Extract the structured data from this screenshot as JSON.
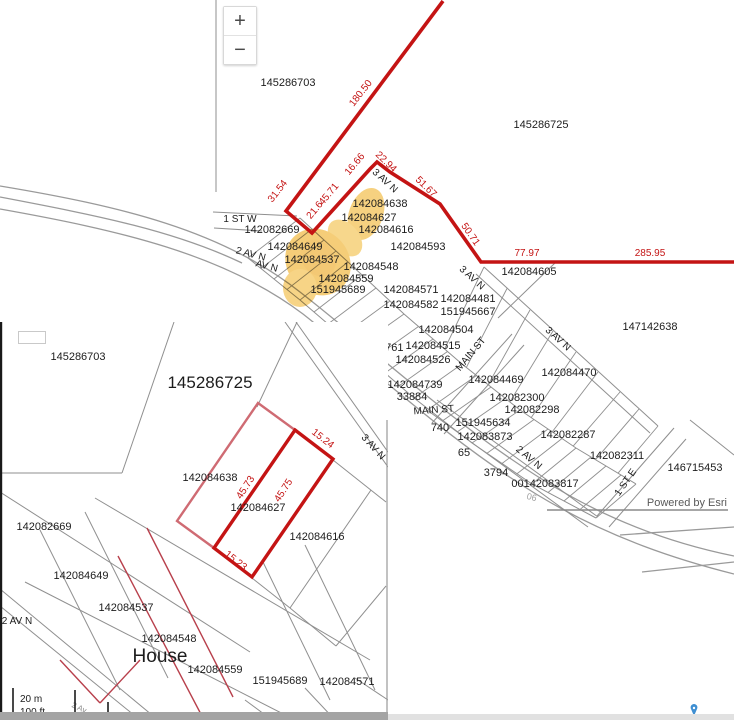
{
  "attribution": {
    "text": "Powered by Esri"
  },
  "zoom_controls": {
    "zoom_in": "+",
    "zoom_out": "−"
  },
  "colors": {
    "boundary_red": "#c41414",
    "thin_red": "#b8404c",
    "pink_red": "#cf6b73",
    "highlight_yellow": "#efab1e",
    "parcel_line_gray": "#8f8f8f",
    "label_black": "#1c1c1c",
    "attribution_gray": "#595959",
    "pin_blue": "#3f8fd2"
  },
  "main_map": {
    "parcel_labels": [
      {
        "t": "145286703",
        "x": 288,
        "y": 86
      },
      {
        "t": "145286725",
        "x": 541,
        "y": 128
      },
      {
        "t": "142084638",
        "x": 380,
        "y": 207
      },
      {
        "t": "142084627",
        "x": 369,
        "y": 221
      },
      {
        "t": "142084616",
        "x": 386,
        "y": 233
      },
      {
        "t": "142082669",
        "x": 272,
        "y": 233
      },
      {
        "t": "142084593",
        "x": 418,
        "y": 250
      },
      {
        "t": "142084649",
        "x": 295,
        "y": 250
      },
      {
        "t": "142084537",
        "x": 312,
        "y": 263
      },
      {
        "t": "142084605",
        "x": 529,
        "y": 275
      },
      {
        "t": "142084548",
        "x": 371,
        "y": 270
      },
      {
        "t": "142084559",
        "x": 346,
        "y": 282
      },
      {
        "t": "151945689",
        "x": 338,
        "y": 293
      },
      {
        "t": "142084571",
        "x": 411,
        "y": 293
      },
      {
        "t": "142084582",
        "x": 411,
        "y": 308
      },
      {
        "t": "142084481",
        "x": 468,
        "y": 302
      },
      {
        "t": "151945667",
        "x": 468,
        "y": 315
      },
      {
        "t": "147142638",
        "x": 650,
        "y": 330
      },
      {
        "t": "142084504",
        "x": 446,
        "y": 333
      },
      {
        "t": "126398",
        "x": 351,
        "y": 339
      },
      {
        "t": "142083761",
        "x": 376,
        "y": 351
      },
      {
        "t": "142084515",
        "x": 433,
        "y": 349
      },
      {
        "t": "142084526",
        "x": 423,
        "y": 363
      },
      {
        "t": "142084470",
        "x": 569,
        "y": 376
      },
      {
        "t": "142084469",
        "x": 496,
        "y": 383
      },
      {
        "t": "142084739",
        "x": 415,
        "y": 388
      },
      {
        "t": "33884",
        "x": 412,
        "y": 400
      },
      {
        "t": "142082300",
        "x": 517,
        "y": 401
      },
      {
        "t": "142082298",
        "x": 532,
        "y": 413
      },
      {
        "t": "151945634",
        "x": 483,
        "y": 426
      },
      {
        "t": "740",
        "x": 440,
        "y": 431
      },
      {
        "t": "142083873",
        "x": 485,
        "y": 440
      },
      {
        "t": "142082287",
        "x": 568,
        "y": 438
      },
      {
        "t": "65",
        "x": 464,
        "y": 456
      },
      {
        "t": "142082311",
        "x": 617,
        "y": 459
      },
      {
        "t": "146715453",
        "x": 695,
        "y": 471
      },
      {
        "t": "3794",
        "x": 496,
        "y": 476
      },
      {
        "t": "00142083817",
        "x": 545,
        "y": 487
      },
      {
        "t": "06",
        "x": 531,
        "y": 500,
        "r": 15,
        "s": 9,
        "c": "#a0a0a0"
      }
    ],
    "street_labels": [
      {
        "t": "1 ST W",
        "x": 240,
        "y": 222
      },
      {
        "t": "2 AV N",
        "x": 250,
        "y": 257,
        "r": 15
      },
      {
        "t": "AV N",
        "x": 266,
        "y": 269,
        "r": 15
      },
      {
        "t": "3 AV N",
        "x": 383,
        "y": 183,
        "r": 42
      },
      {
        "t": "3 AV N",
        "x": 470,
        "y": 280,
        "r": 42
      },
      {
        "t": "3 AV N",
        "x": 556,
        "y": 341,
        "r": 42
      },
      {
        "t": "MAIN ST",
        "x": 473,
        "y": 356,
        "r": -50
      },
      {
        "t": "MAIN ST",
        "x": 434,
        "y": 413,
        "r": -4
      },
      {
        "t": "2 AV N",
        "x": 527,
        "y": 460,
        "r": 40
      },
      {
        "t": "1 ST E",
        "x": 628,
        "y": 484,
        "r": -55
      }
    ],
    "measurements": [
      {
        "t": "180.50",
        "x": 363,
        "y": 95,
        "r": -52
      },
      {
        "t": "31.54",
        "x": 280,
        "y": 193,
        "r": -52
      },
      {
        "t": "21.6",
        "x": 317,
        "y": 212,
        "r": -50
      },
      {
        "t": "45.71",
        "x": 331,
        "y": 196,
        "r": -50
      },
      {
        "t": "16.66",
        "x": 357,
        "y": 166,
        "r": -50
      },
      {
        "t": "22.94",
        "x": 384,
        "y": 164,
        "r": 44
      },
      {
        "t": "51.67",
        "x": 424,
        "y": 189,
        "r": 44
      },
      {
        "t": "50.71",
        "x": 468,
        "y": 236,
        "r": 55
      },
      {
        "t": "77.97",
        "x": 527,
        "y": 256,
        "r": 0
      },
      {
        "t": "285.95",
        "x": 650,
        "y": 256,
        "r": 0
      }
    ]
  },
  "inset_map": {
    "parcel_labels": [
      {
        "t": "145286703",
        "x": 78,
        "y": 360
      },
      {
        "t": "145286725",
        "x": 210,
        "y": 388,
        "s": 17
      },
      {
        "t": "142084638",
        "x": 210,
        "y": 481
      },
      {
        "t": "142084627",
        "x": 258,
        "y": 511
      },
      {
        "t": "142084616",
        "x": 317,
        "y": 540
      },
      {
        "t": "142082669",
        "x": 44,
        "y": 530
      },
      {
        "t": "142084649",
        "x": 81,
        "y": 579
      },
      {
        "t": "142084537",
        "x": 126,
        "y": 611
      },
      {
        "t": "142084548",
        "x": 169,
        "y": 642
      },
      {
        "t": "House",
        "x": 160,
        "y": 662,
        "s": 19
      },
      {
        "t": "142084559",
        "x": 215,
        "y": 673
      },
      {
        "t": "151945689",
        "x": 280,
        "y": 684
      },
      {
        "t": "142084571",
        "x": 347,
        "y": 685
      },
      {
        "t": "2 Av",
        "x": 78,
        "y": 710,
        "r": 25,
        "s": 8,
        "c": "#8a8a8a"
      }
    ],
    "street_labels": [
      {
        "t": "3 AV N",
        "x": 371,
        "y": 449,
        "r": 48
      },
      {
        "t": "2 AV N",
        "x": 17,
        "y": 624,
        "s": 10
      }
    ],
    "measurements": [
      {
        "t": "15.24",
        "x": 321,
        "y": 441,
        "r": 38
      },
      {
        "t": "45.73",
        "x": 248,
        "y": 489,
        "r": -57
      },
      {
        "t": "45.75",
        "x": 286,
        "y": 492,
        "r": -57
      },
      {
        "t": "15.23",
        "x": 234,
        "y": 563,
        "r": 38
      }
    ],
    "scale_bar": {
      "metric": "20 m",
      "imperial": "100 ft"
    }
  }
}
